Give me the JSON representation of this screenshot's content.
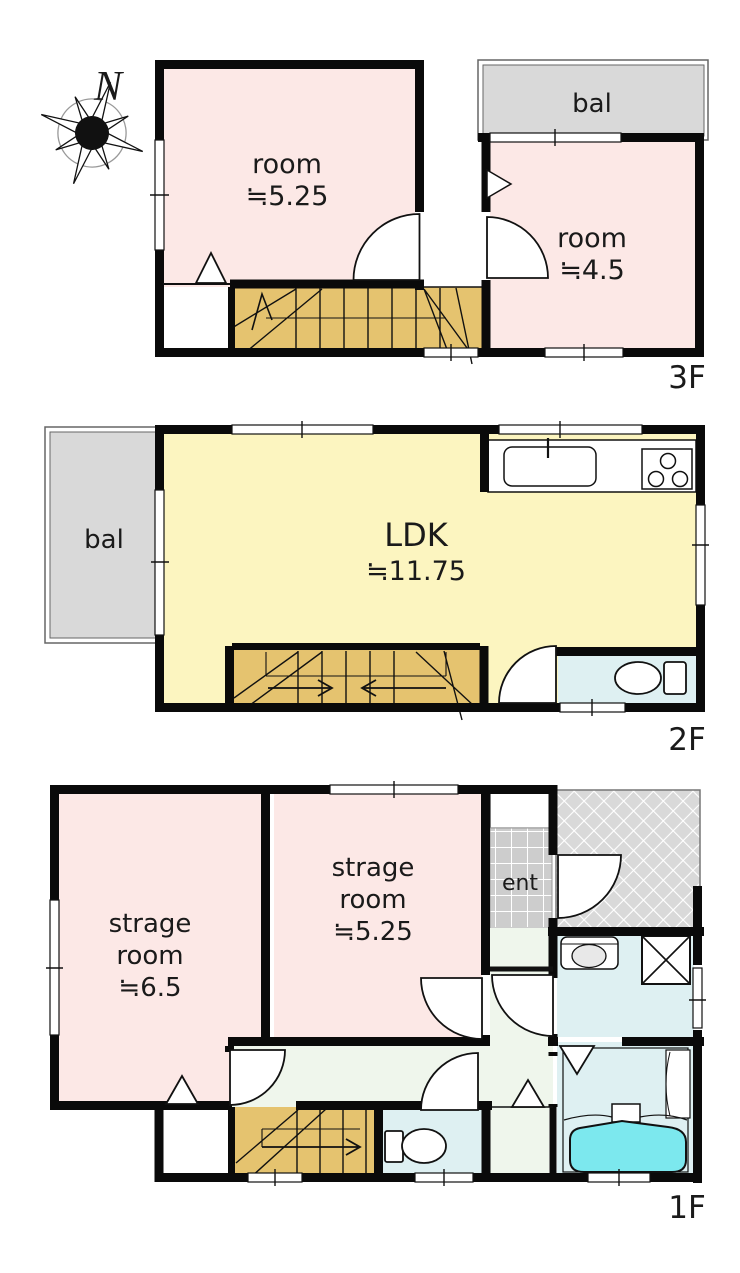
{
  "compass": {
    "label": "N"
  },
  "floor3": {
    "floor_label": "3F",
    "room_a": {
      "name": "room",
      "area": "≒5.25"
    },
    "room_b": {
      "name": "room",
      "area": "≒4.5"
    },
    "balcony_label": "bal"
  },
  "floor2": {
    "floor_label": "2F",
    "ldk": {
      "name": "LDK",
      "area": "≒11.75"
    },
    "balcony_label": "bal"
  },
  "floor1": {
    "floor_label": "1F",
    "storage_a": {
      "name_line1": "strage",
      "name_line2": "room",
      "area": "≒6.5"
    },
    "storage_b": {
      "name_line1": "strage",
      "name_line2": "room",
      "area": "≒5.25"
    },
    "entrance_label": "ent"
  },
  "colors": {
    "room_pink": "#fce8e6",
    "ldk_yellow": "#fcf5c0",
    "stair_tan": "#e5c36f",
    "balcony_gray": "#d9d9d9",
    "wet_area_blue": "#def0f2",
    "bathtub_cyan": "#7ce8ee",
    "hallway_green": "#eff6ec",
    "entrance_tile_gray": "#cdcdcd",
    "wall_black": "#0a0a0a"
  }
}
